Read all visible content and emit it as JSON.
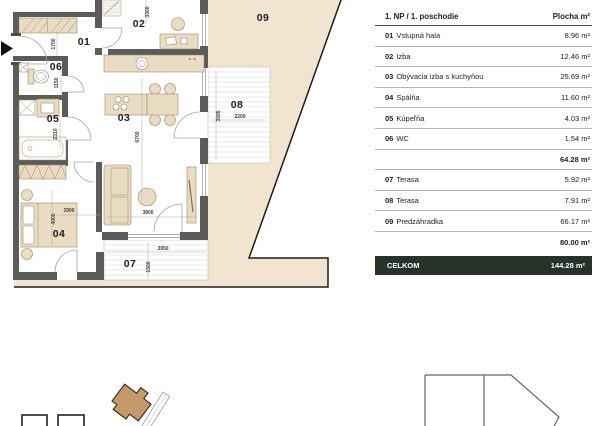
{
  "colors": {
    "garden_fill": "#f1e4d0",
    "furniture_fill": "#eadcc3",
    "wall": "#5b5b5a",
    "boundary": "#1d1d1b",
    "highlight_building": "#c59a69",
    "total_bar_bg": "#27322a",
    "total_bar_text": "#ffffff",
    "text": "#1d1d1b"
  },
  "plan": {
    "labels": [
      {
        "t": "01"
      },
      {
        "t": "02"
      },
      {
        "t": "03"
      },
      {
        "t": "04"
      },
      {
        "t": "05"
      },
      {
        "t": "06"
      },
      {
        "t": "07"
      },
      {
        "t": "08"
      },
      {
        "t": "09"
      }
    ],
    "dims": [
      {
        "t": "3300"
      },
      {
        "t": "1700"
      },
      {
        "t": "1150"
      },
      {
        "t": "2310"
      },
      {
        "t": "6700"
      },
      {
        "t": "3595"
      },
      {
        "t": "2200"
      },
      {
        "t": "4000"
      },
      {
        "t": "2900"
      },
      {
        "t": "3800"
      },
      {
        "t": "3950"
      },
      {
        "t": "1500"
      }
    ]
  },
  "legend": {
    "header": {
      "title": "1. NP / 1. poschodie",
      "area_label": "Plocha m²"
    },
    "rows": [
      {
        "num": "01",
        "name": "Vstupná hala",
        "area": "8.96 m²"
      },
      {
        "num": "02",
        "name": "Izba",
        "area": "12.46 m²"
      },
      {
        "num": "03",
        "name": "Obývacia izba s kuchyňou",
        "area": "25.69 m²"
      },
      {
        "num": "04",
        "name": "Spálňa",
        "area": "11.60 m²"
      },
      {
        "num": "05",
        "name": "Kúpeľňa",
        "area": "4.03 m²"
      },
      {
        "num": "06",
        "name": "WC",
        "area": "1.54 m²"
      },
      {
        "area": "64.28 m²"
      },
      {
        "num": "07",
        "name": "Terasa",
        "area": "5.92 m²"
      },
      {
        "num": "08",
        "name": "Terasa",
        "area": "7.91 m²"
      },
      {
        "num": "09",
        "name": "Predzáhradka",
        "area": "66.17 m²"
      },
      {
        "area": "80.00 m²"
      }
    ],
    "total": {
      "label": "CELKOM",
      "area": "144.28 m²"
    }
  }
}
